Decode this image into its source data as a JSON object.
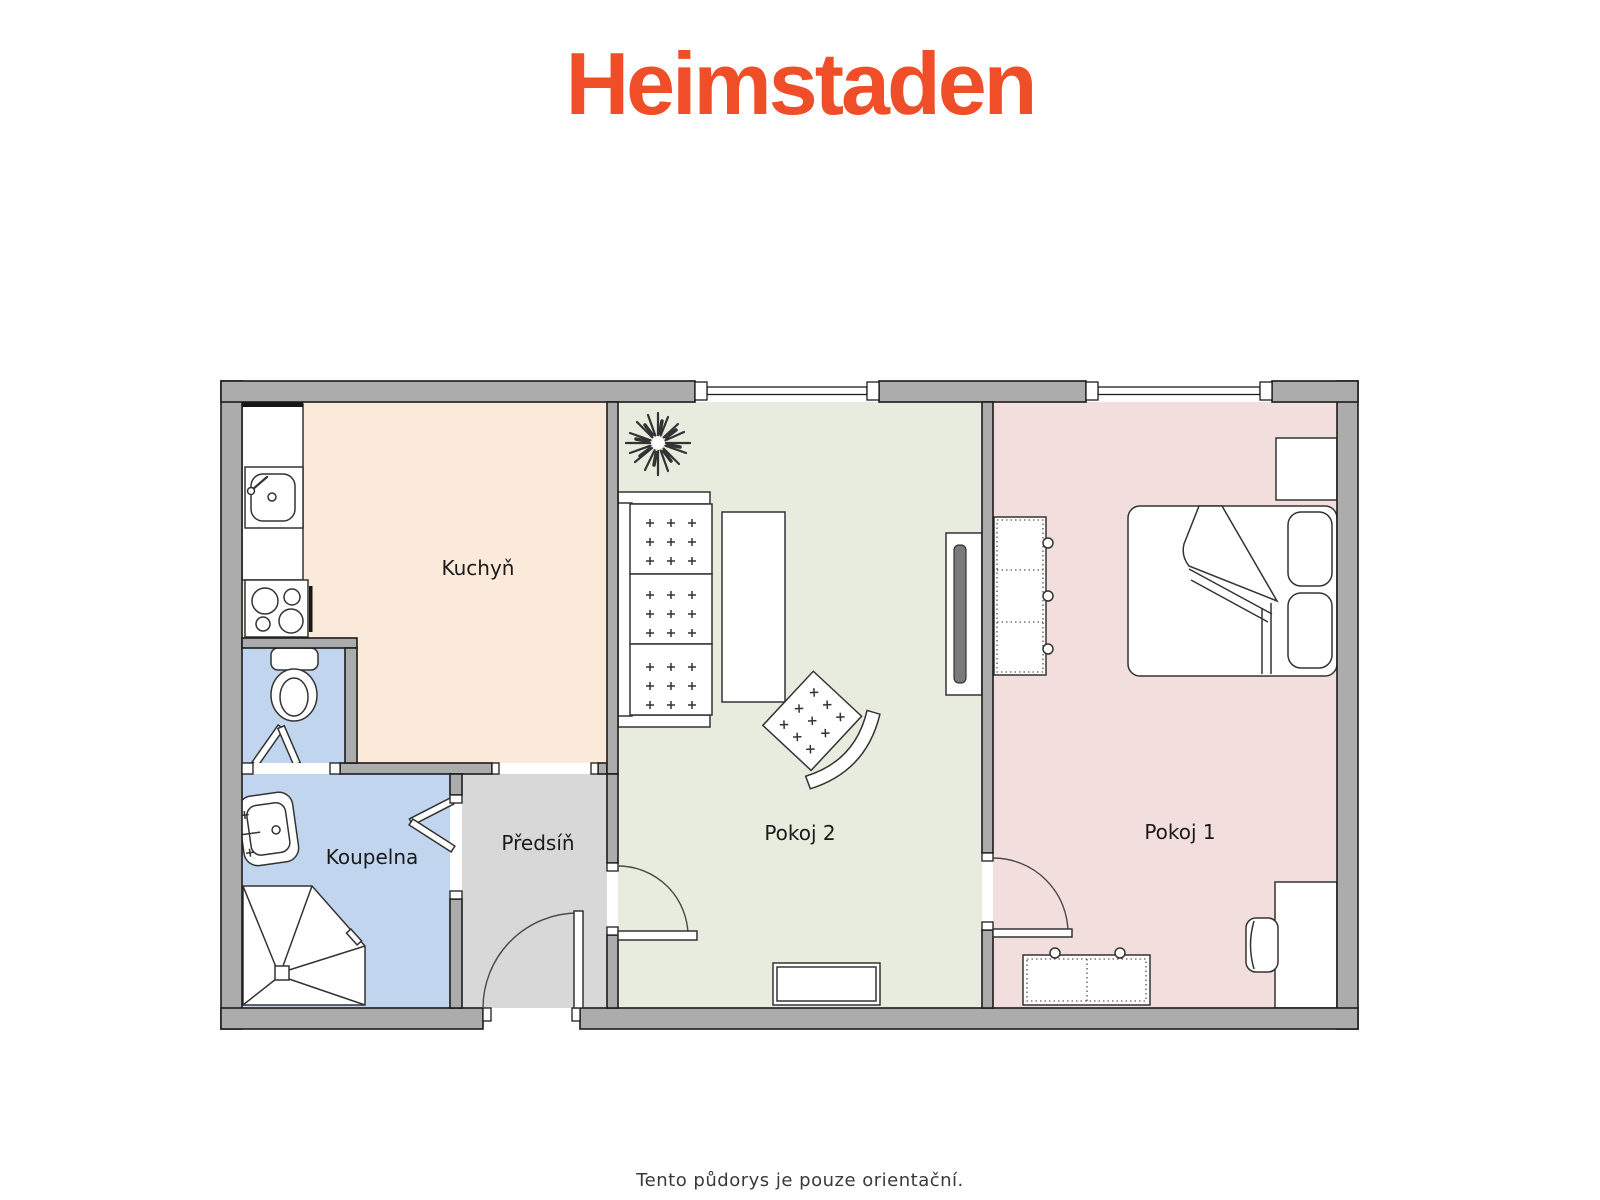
{
  "page": {
    "width": 1600,
    "height": 1200
  },
  "logo": {
    "text": "Heimstaden"
  },
  "footer": {
    "note": "Tento půdorys je pouze orientační."
  },
  "floorplan": {
    "rooms": [
      {
        "id": "kuchyn",
        "label": "Kuchyň"
      },
      {
        "id": "koupelna",
        "label": "Koupelna"
      },
      {
        "id": "predsin",
        "label": "Předsíň"
      },
      {
        "id": "pokoj2",
        "label": "Pokoj 2"
      },
      {
        "id": "pokoj1",
        "label": "Pokoj 1"
      }
    ],
    "icons": [
      "kitchen-sink-icon",
      "stove-icon",
      "toilet-icon",
      "folding-door-icon",
      "bathroom-sink-icon",
      "shower-icon",
      "entrance-door-icon",
      "door-icon",
      "window-icon",
      "plant-icon",
      "sofa-icon",
      "coffee-table-icon",
      "armchair-icon",
      "tv-icon",
      "sideboard-icon",
      "wardrobe-icon",
      "double-bed-icon",
      "nightstand-icon",
      "dresser-icon",
      "desk-icon",
      "desk-chair-icon"
    ]
  },
  "colors": {
    "wall": "#ACACAC",
    "wall_outline": "#1C1C1C",
    "furniture_outline": "#333333",
    "kitchen": "#FBE9DA",
    "bath": "#C2D5EF",
    "hall": "#D8D8D8",
    "room2": "#E7ECDE",
    "room1": "#F2DEDD",
    "screen": "#7A7A7A",
    "logo": "#F04E28",
    "footer_text": "#3A3A3A",
    "label_text": "#1A1A1A"
  }
}
